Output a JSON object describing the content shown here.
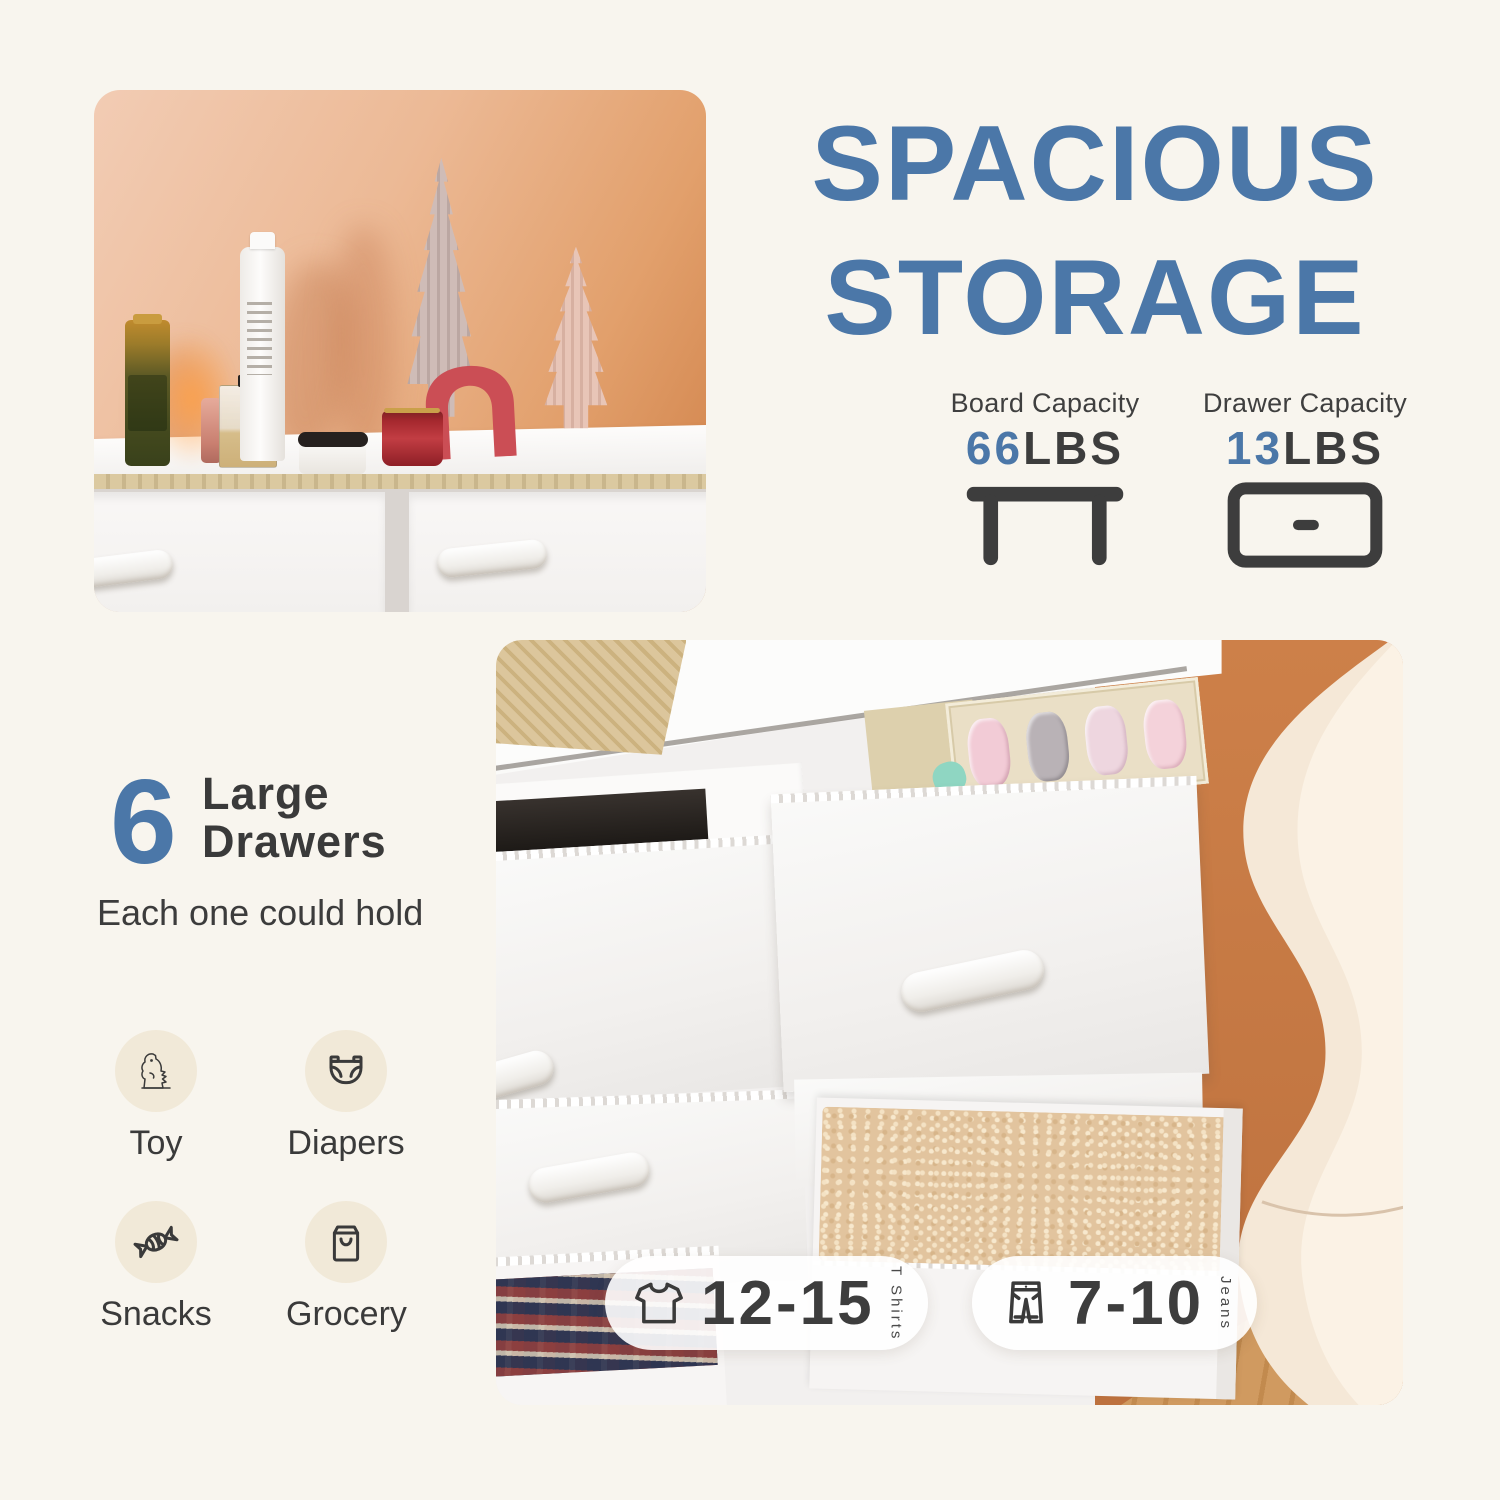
{
  "title": {
    "line1": "SPACIOUS",
    "line2": "STORAGE"
  },
  "capacities": [
    {
      "label": "Board Capacity",
      "value": "66",
      "unit": "LBS",
      "icon": "table-icon"
    },
    {
      "label": "Drawer Capacity",
      "value": "13",
      "unit": "LBS",
      "icon": "drawer-icon"
    }
  ],
  "feature": {
    "count": "6",
    "heading_line1": "Large",
    "heading_line2": "Drawers",
    "subheading": "Each one could hold",
    "items": [
      {
        "label": "Toy",
        "icon": "dinosaur-icon"
      },
      {
        "label": "Diapers",
        "icon": "diaper-icon"
      },
      {
        "label": "Snacks",
        "icon": "candy-icon"
      },
      {
        "label": "Grocery",
        "icon": "grocery-bag-icon"
      }
    ]
  },
  "capacity_badges": [
    {
      "value": "12-15",
      "unit": "T Shirts",
      "icon": "tshirt-icon"
    },
    {
      "value": "7-10",
      "unit": "Jeans",
      "icon": "jeans-icon"
    }
  ],
  "colors": {
    "background": "#f8f5ee",
    "title_blue": "#4b77a8",
    "text_dark": "#3d3d3d",
    "icon_circle_beige": "#f1e9d8",
    "badge_background": "rgba(255,255,255,0.9)"
  },
  "photos": [
    {
      "name": "dresser-top-decor",
      "description": "White dresser top with cosmetics, red arch and ceramic trees against a peach wall"
    },
    {
      "name": "dresser-open-drawers",
      "description": "Close-up of white fabric dresser with open drawers holding folded clothes and a blanket"
    }
  ]
}
